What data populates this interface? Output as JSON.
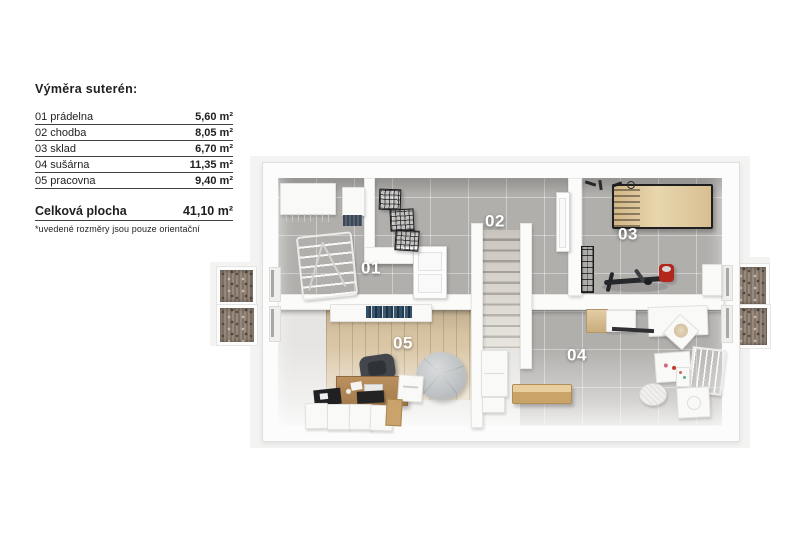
{
  "legend": {
    "title": "Výměra suterén:",
    "rows": [
      {
        "label": "01 prádelna",
        "value": "5,60 m²"
      },
      {
        "label": "02 chodba",
        "value": "8,05 m²"
      },
      {
        "label": "03 sklad",
        "value": "6,70 m²"
      },
      {
        "label": "04 sušárna",
        "value": "11,35 m²"
      },
      {
        "label": "05 pracovna",
        "value": "9,40 m²"
      }
    ],
    "total": {
      "label": "Celková plocha",
      "value": "41,10 m²"
    },
    "footnote": "*uvedené rozměry jsou pouze orientační"
  },
  "floorplan": {
    "room_numbers": [
      "01",
      "02",
      "03",
      "04",
      "05"
    ],
    "colors": {
      "backdrop": "#f3f3f2",
      "wall": "#fbfbfa",
      "tile_floor": "#b1afac",
      "tile_grout": "#c6c4c1",
      "wood_floor": "#d8c4a2",
      "stair_carpet": "#d8d3cb",
      "gravel_well": "#8b7c6e",
      "bench_wood": "#d4ac73",
      "room_label_text": "#ffffff"
    }
  }
}
